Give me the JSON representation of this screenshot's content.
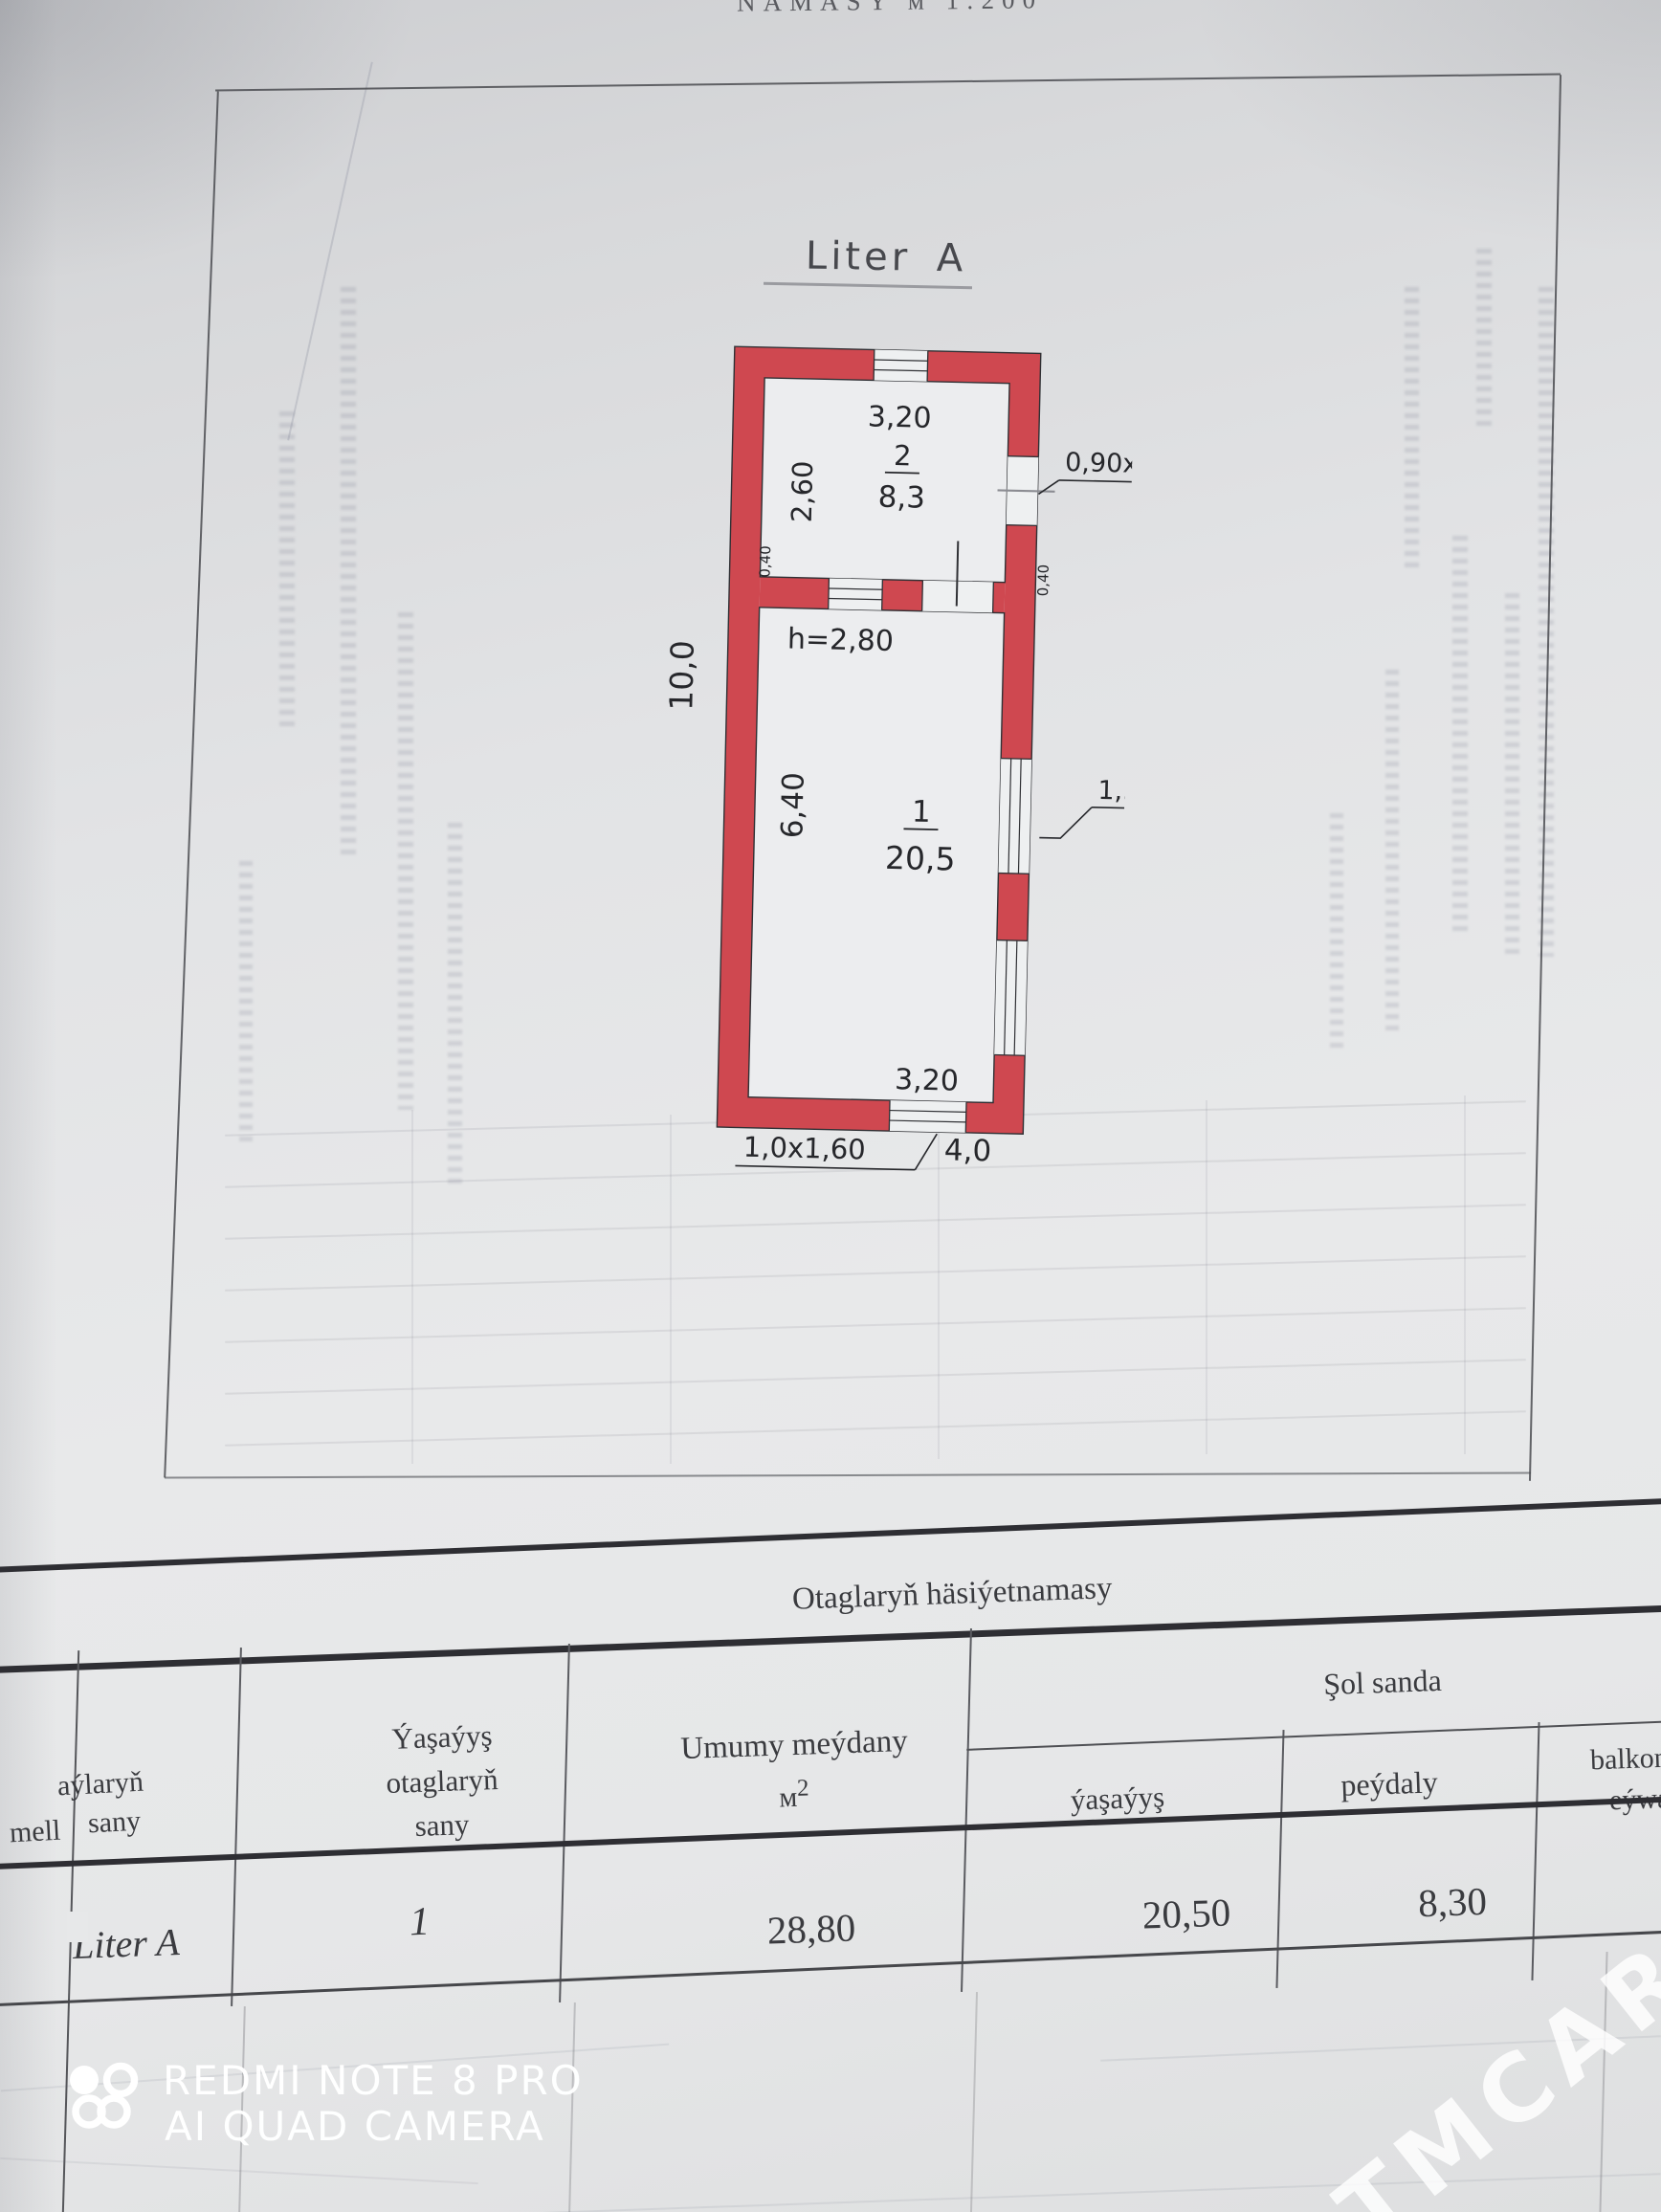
{
  "photo": {
    "top_caption_fragment": "NAMASY  м  1:200",
    "camera_watermark_line1": "REDMI NOTE 8 PRO",
    "camera_watermark_line2": "AI QUAD CAMERA",
    "site_watermark": "TMCARS",
    "site_watermark_partial": "TMCARS"
  },
  "plan": {
    "title": "Liter A",
    "dim_top": "3,20",
    "room2_no": "2",
    "room2_area": "8,3",
    "room2_height": "2,60",
    "door_label": "0,90x2,10",
    "ceiling": "h=2,80",
    "total_height": "10,0",
    "wall_thickness_left": "0,40",
    "wall_thickness_right": "0,40",
    "room1_no": "1",
    "room1_area": "20,5",
    "room1_height": "6,40",
    "window_label": "1,50x1,50",
    "dim_bottom": "3,20",
    "door_bottom": "1,0x1,60",
    "total_width": "4,0",
    "wall_color": "#cf4850"
  },
  "table": {
    "section_title": "Otaglaryň  häsiýetnamasy",
    "col_group": "Şol  sanda",
    "col1_l1": "aýlaryň",
    "col1_l2": "mell",
    "col1_l3": "sany",
    "col2_l1": "Ýaşaýyş",
    "col2_l2": "otaglaryň",
    "col2_l3": "sany",
    "col3_title": "Umumy  meýdany",
    "col3_unit": "м",
    "col3_unit_sup": "2",
    "sub1": "ýaşaýyş",
    "sub2": "peýdaly",
    "sub3_l1": "balkon",
    "sub3_l2": "eýwan",
    "row": {
      "name": "Liter A",
      "rooms": "1",
      "total": "28,80",
      "living": "20,50",
      "useful": "8,30"
    }
  }
}
